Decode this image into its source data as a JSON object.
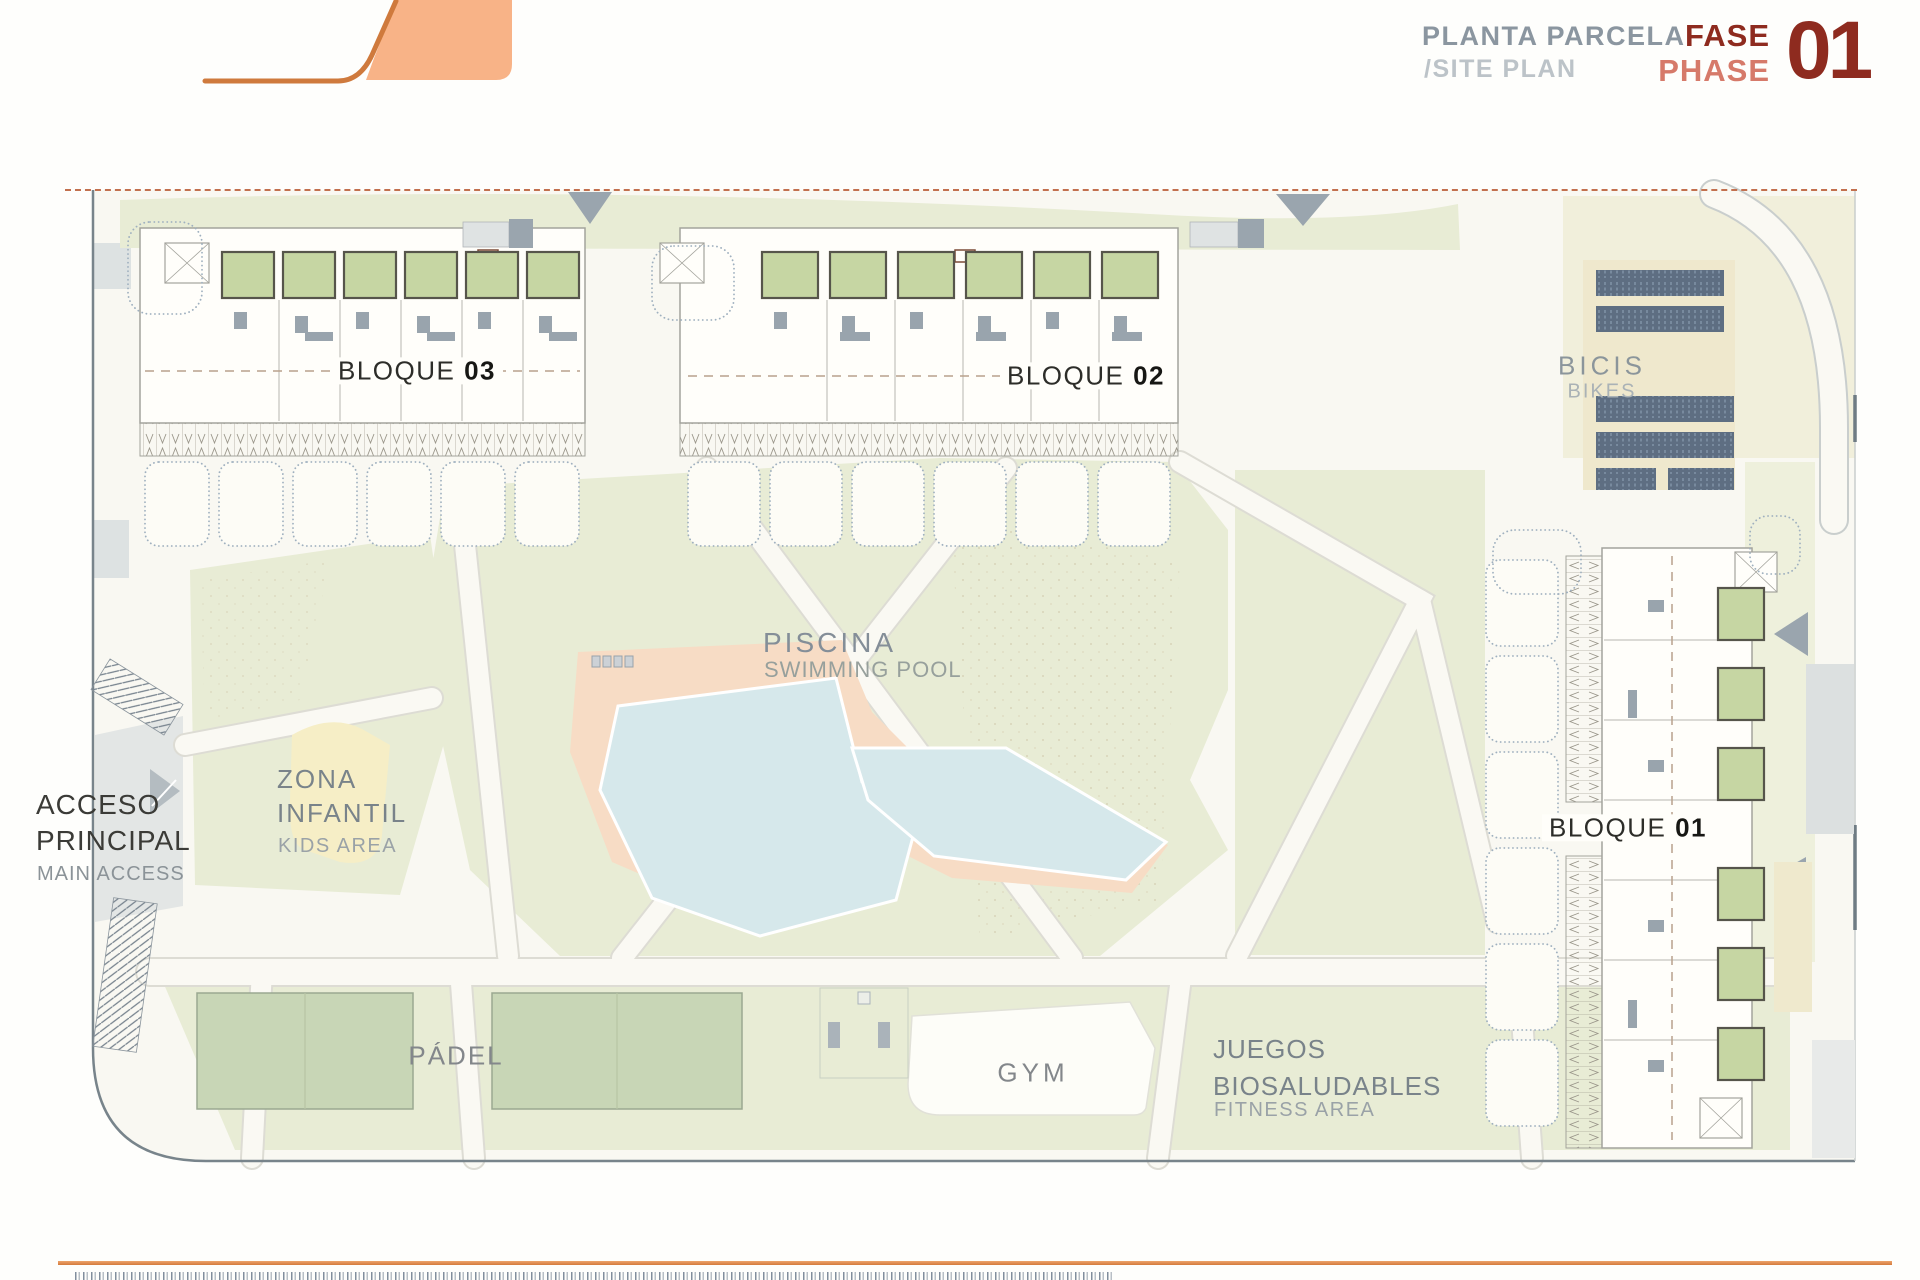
{
  "header": {
    "title_primary": "PLANTA PARCELA",
    "title_secondary": "/SITE PLAN",
    "phase_word_primary": "FASE",
    "phase_word_secondary": "PHASE",
    "phase_number": "01"
  },
  "labels": {
    "block03": {
      "word": "BLOQUE",
      "number": "03"
    },
    "block02": {
      "word": "BLOQUE",
      "number": "02"
    },
    "block01": {
      "word": "BLOQUE",
      "number": "01"
    },
    "bikes": {
      "primary": "BICIS",
      "secondary": "BIKES"
    },
    "pool": {
      "primary": "PISCINA",
      "secondary": "SWIMMING POOL"
    },
    "kids": {
      "line1": "ZONA",
      "line2": "INFANTIL",
      "secondary": "KIDS AREA"
    },
    "access": {
      "line1": "ACCESO",
      "line2": "PRINCIPAL",
      "secondary": "MAIN ACCESS"
    },
    "padel": {
      "primary": "PÁDEL"
    },
    "gym": {
      "primary": "GYM"
    },
    "fitness": {
      "line1": "JUEGOS",
      "line2": "BIOSALUDABLES",
      "secondary": "FITNESS AREA"
    }
  },
  "colors": {
    "accent_orange": "#d47a3c",
    "logo_fill": "#f8b387",
    "logo_stroke": "#cf7a3d",
    "phase_dark_red": "#8e2b1f",
    "phase_light_red": "#d67a6a",
    "title_gray": "#8b96a0",
    "title_light_gray": "#bcc3c8",
    "grass_green": "#e8ecd5",
    "pool_blue": "#d6e8eb",
    "pool_deck_peach": "#f7dcc5",
    "padel_green": "#c8d6b6",
    "unit_terrace_green": "#c6d6a3",
    "bikes_cream": "#efe8cd",
    "bikes_rack_blue": "#5e6e82",
    "kids_yellow": "#f6eec6",
    "boundary_dash_red": "#c2704e"
  }
}
